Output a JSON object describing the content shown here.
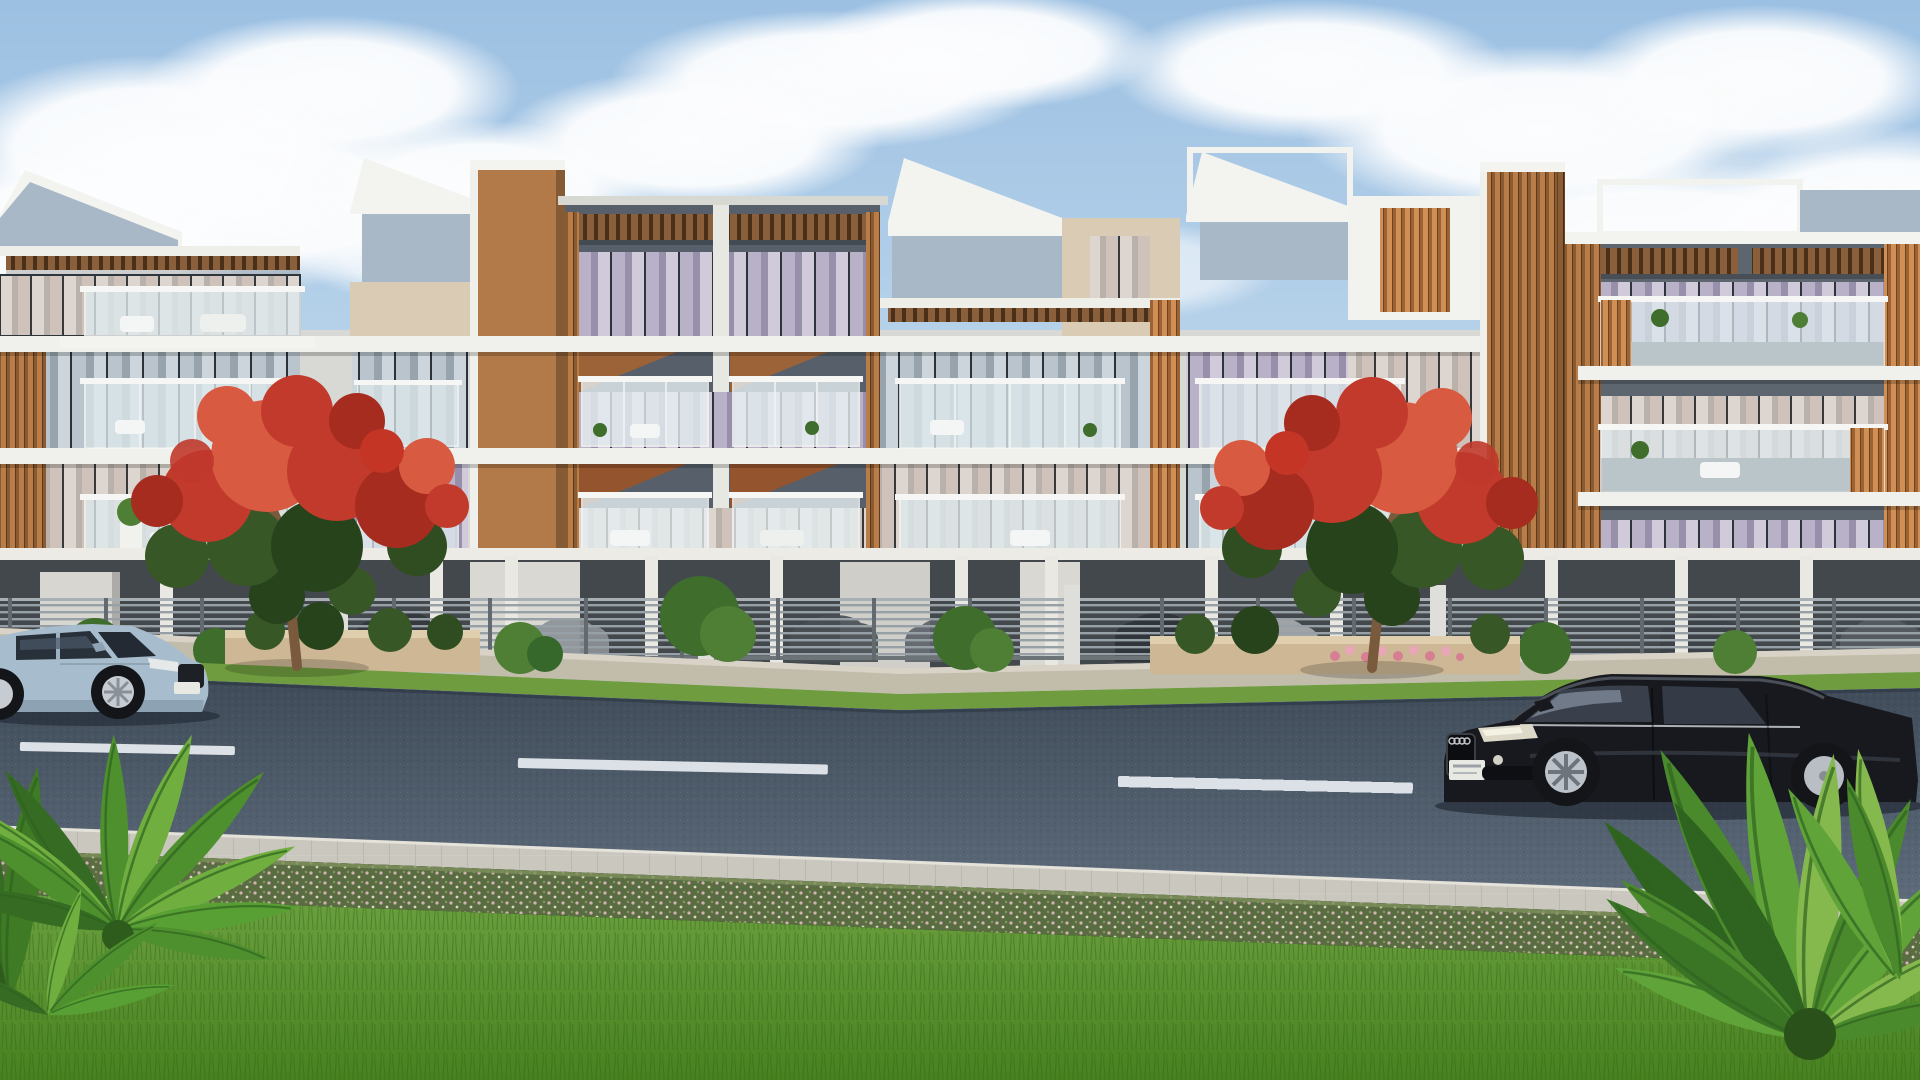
{
  "scene": {
    "type": "photorealistic 3D architectural rendering",
    "setting": "sunny daytime street elevation of a modern low-rise residential complex",
    "elements": [
      "row of four-storey apartment blocks with white fascias, grey-blue and beige panels, vertical timber louvers, wood pergola canopies and glass balconies with white outdoor furniture",
      "two red-flowering gulmohar trees in beige stone planters on the far sidewalk",
      "grey horizontal-slat boundary fence with stilt parking and parked cars behind it",
      "dark asphalt road with white dashed lane markings",
      "light steel-blue luxury SUV driving on the far lane facing right",
      "black luxury sedan driving on the near lane facing left",
      "near-side paved walkway, flowering hedge row and large green lawn",
      "bright green palm plant in bottom-left corner and large fern in bottom-right corner",
      "blue sky with white cumulus clouds"
    ]
  },
  "objects": {
    "suv": {
      "kind": "luxury SUV",
      "body_color_name": "light steel blue",
      "facing": "right",
      "license_plate": "illegible"
    },
    "sedan": {
      "kind": "luxury sedan",
      "body_color_name": "black",
      "facing": "left",
      "license_plate": "illegible"
    },
    "trees": {
      "count": 2,
      "species_look": "gulmohar / royal poinciana",
      "bloom_color_name": "red-orange"
    },
    "lane_markings": {
      "style": "white dashed center line",
      "dash_count_visible": 3
    }
  },
  "colors": {
    "sky_top": "#9cc0e2",
    "sky_low": "#d7e8f4",
    "cloud": "#ffffff",
    "back_wall": "#d8d9d5",
    "bldg_white": "#f3f4f0",
    "slab_white": "#f0f1ec",
    "panel_blue": "#a9b8c6",
    "panel_beige": "#d9cbb4",
    "facade_dark": "#57606a",
    "facade_dark2": "#5d656e",
    "wood": "#b27a48",
    "wood_dark": "#7c5128",
    "window_dark": "#2e353b",
    "balcony_glass": "#dfeaee",
    "rail_white": "#f6f7f5",
    "parking_dark": "#43484d",
    "column_white": "#e9e8e3",
    "fence_grey": "#97a0a6",
    "sidewalk": "#c2bcab",
    "planter": "#cdb795",
    "grass_verge": "#6f9c3f",
    "road_top": "#3e4a57",
    "road_bottom": "#5d6b7b",
    "marking": "#e9eef2",
    "walkway": "#cac7bf",
    "hedge": "#5a6d42",
    "lawn_top": "#6ca03f",
    "lawn_bottom": "#47821f",
    "tree_red": "#c23a2b",
    "tree_red_dark": "#a52c1f",
    "tree_red_light": "#d85a40",
    "tree_green": "#375726",
    "tree_green_dark": "#27431b",
    "trunk": "#7a5a3c",
    "suv_body": "#a7bccd",
    "sedan_body": "#17191e",
    "tire": "#141518",
    "alloy": "#bcc2c9",
    "plate": "#e9e9e4",
    "palm_green": "#4e8f2e",
    "palm_light": "#6fae3f",
    "palm_dark": "#356b22",
    "fern_light": "#86b94d"
  }
}
